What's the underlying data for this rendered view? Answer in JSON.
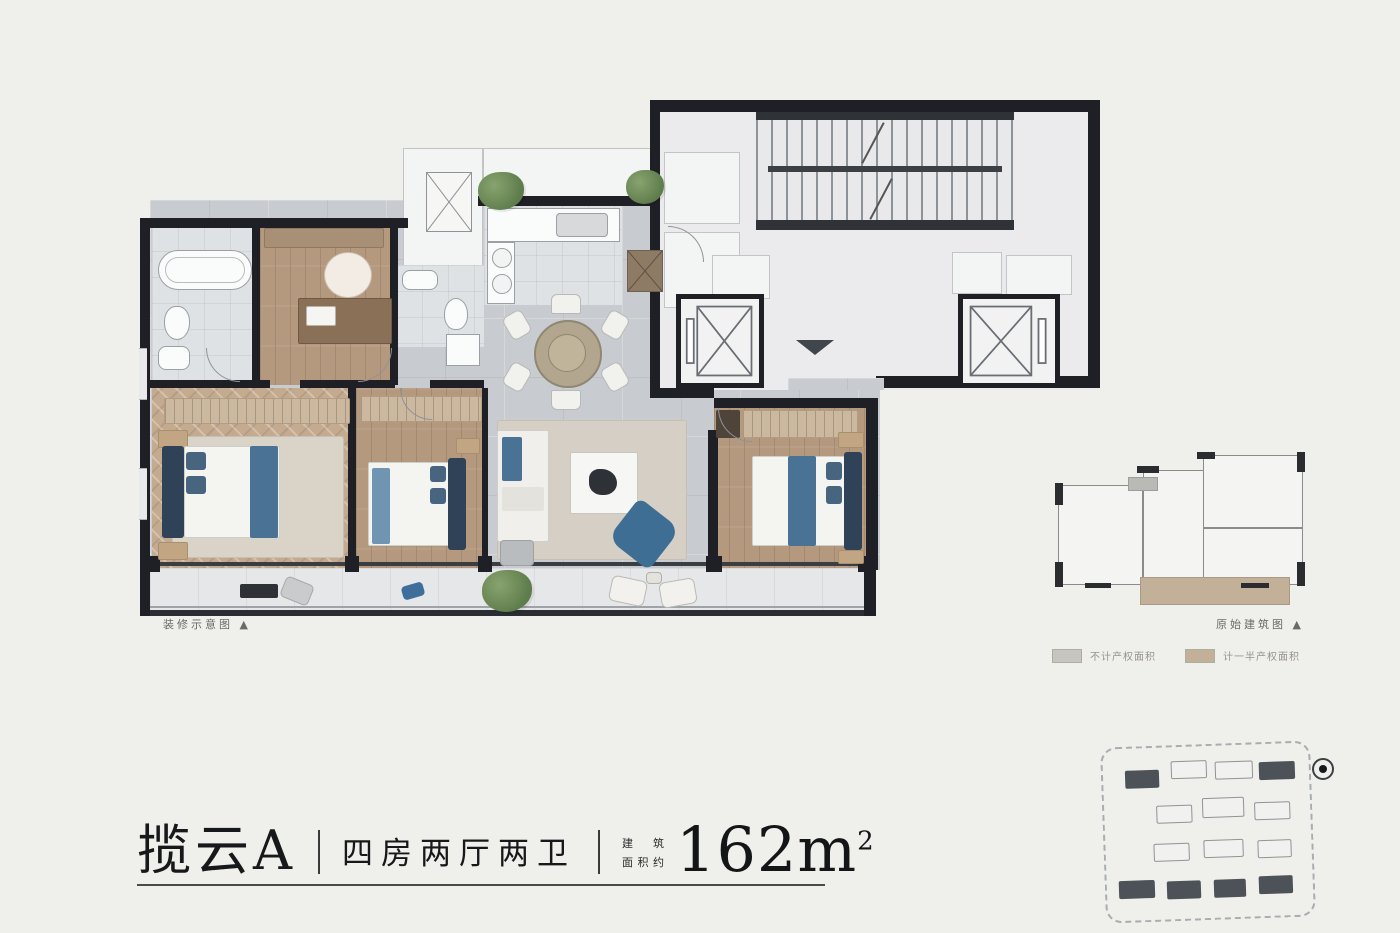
{
  "title": {
    "name": "揽云A",
    "layout": "四房两厅两卫",
    "area_label_line1": "建筑",
    "area_label_line2": "面积约",
    "area_value": "162m",
    "area_sup": "2"
  },
  "captions": {
    "left": "装修示意图 ▲",
    "right": "原始建筑图 ▲"
  },
  "legend": {
    "items": [
      {
        "label": "不计产权面积",
        "style": "background:#c6c5c0"
      },
      {
        "label": "计一半产权面积",
        "style": "background:#c3b099"
      }
    ]
  },
  "colors": {
    "page_bg": "#efefec",
    "wall": "#1e2025",
    "tile_floor": "#c8cbcf",
    "wood_floor": "#b4997e",
    "herringbone_floor": "#c4aa8f",
    "accent_blue": "#4a7294",
    "balcony_key_tan": "#c3b099",
    "plant_green": "#6d8a5b"
  }
}
